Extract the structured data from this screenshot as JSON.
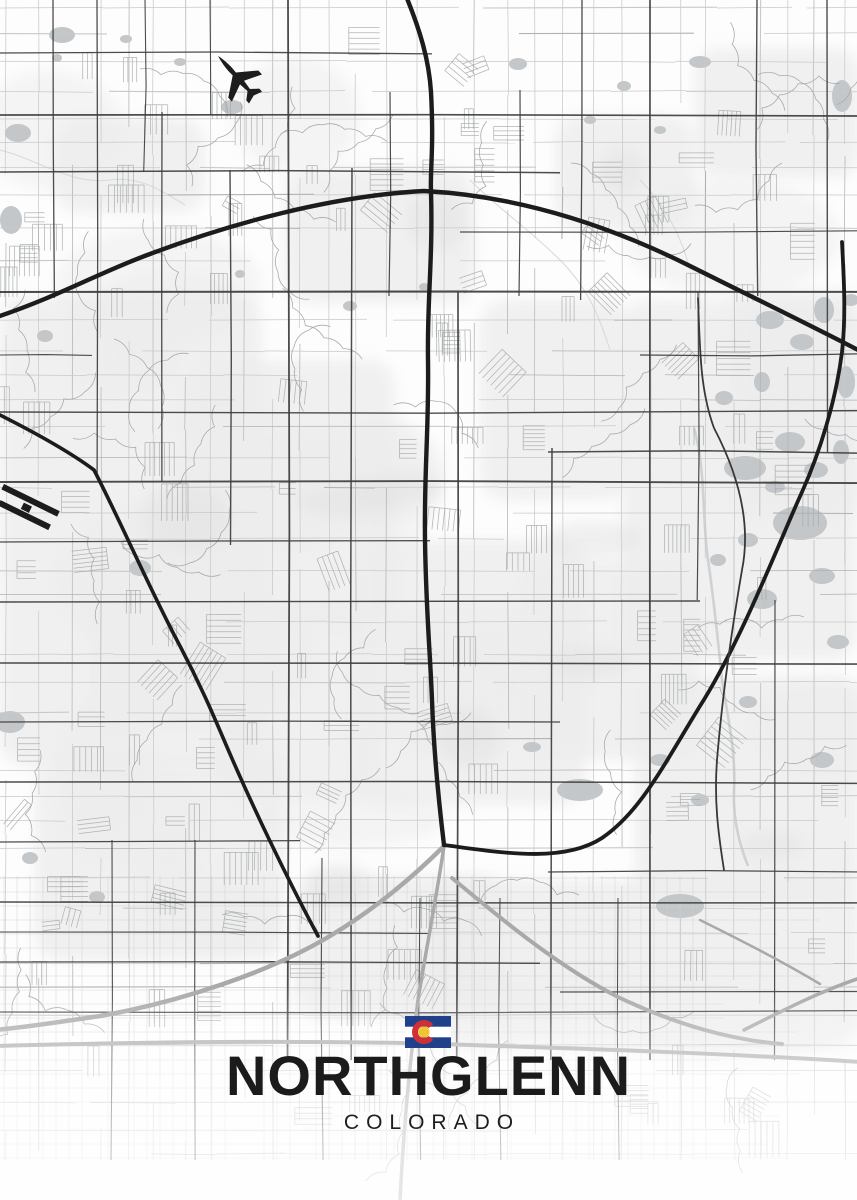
{
  "poster": {
    "title": "NORTHGLENN",
    "subtitle": "COLORADO",
    "flag": {
      "blue": "#20408c",
      "white": "#ffffff",
      "red": "#cf3038",
      "gold": "#f3c432"
    }
  },
  "map": {
    "width": 857,
    "height": 1200,
    "seed": 1337,
    "palette": {
      "bg": "#fdfdfd",
      "patch": "#ededed",
      "patch_dark": "#e2e2e2",
      "water": "#c3c7c9",
      "river": "#ced2d3",
      "stream": "#d8dadb",
      "minor": "#c9c9c9",
      "fine": "#d0d0d0",
      "texture": "#a4a8aa",
      "squiggle": "#a8acae",
      "arterial": "#3d3d3d",
      "highway": "#1c1c1c",
      "highway2": "#383838",
      "gray_highway": "#a9a9a9",
      "fade": "#ffffff"
    },
    "highways": {
      "beltway": {
        "d": "M -6 318 C 60 296 100 272 150 254 C 230 224 330 196 424 191 C 520 196 610 226 690 266 C 750 296 804 322 862 352",
        "w": 4.4
      },
      "i25": {
        "d": "M 406 -4 C 420 30 429 60 431 92 C 434 150 430 170 431 192 C 433 260 427 300 428 360 C 429 430 424 470 425 540 C 426 610 430 650 432 700 C 434 760 440 812 444 845",
        "w": 4.4
      },
      "us85_ne": {
        "d": "M 444 845 C 498 852 562 864 602 838 C 640 812 662 768 700 706 C 742 640 780 540 802 492 C 820 452 836 400 842 352 C 846 316 844 280 842 242",
        "w": 3.8
      },
      "us36_nw": {
        "d": "M -6 412 C 30 430 70 452 94 470 C 120 520 150 590 180 646 C 200 684 212 712 224 740 C 252 806 288 880 318 936",
        "w": 3.6
      },
      "ne_parallel": {
        "d": "M 698 298 C 700 350 700 390 714 428 C 736 470 752 520 742 570 C 730 640 722 700 717 760 C 714 800 718 832 724 870",
        "w": 1.8,
        "alt": true
      }
    },
    "gray_highways": {
      "us36_sw": {
        "d": "M 444 846 C 420 870 380 906 330 936 C 270 972 180 1002 100 1016 C 60 1022 20 1028 -6 1030",
        "w": 4.5
      },
      "i25_s": {
        "d": "M 444 846 C 436 900 426 950 418 1000 C 410 1060 404 1120 400 1200",
        "w": 3.5
      },
      "bottom_av": {
        "d": "M -6 1046 C 150 1042 300 1040 440 1044 C 560 1048 700 1052 862 1062",
        "w": 4.0
      },
      "i76_se": {
        "d": "M 452 878 C 500 918 560 968 620 998 C 680 1026 732 1040 782 1044",
        "w": 4.0
      },
      "ne_branch": {
        "d": "M 744 1030 C 780 1012 818 992 860 978",
        "w": 3.5
      },
      "right_link": {
        "d": "M 700 920 C 740 940 780 960 820 984",
        "w": 2.5
      }
    },
    "arterials": {
      "vertical": [
        [
          53,
          0,
          298,
          1.3
        ],
        [
          97,
          0,
          478,
          1.3
        ],
        [
          145,
          0,
          172,
          1.1
        ],
        [
          162,
          112,
          482,
          1.3
        ],
        [
          210,
          0,
          115,
          1.1
        ],
        [
          230,
          170,
          545,
          1.4
        ],
        [
          288,
          0,
          1060,
          1.8
        ],
        [
          322,
          858,
          1160,
          1.1
        ],
        [
          352,
          168,
          1060,
          1.5
        ],
        [
          390,
          92,
          296,
          1.2
        ],
        [
          458,
          292,
          1060,
          1.7
        ],
        [
          520,
          90,
          296,
          1.2
        ],
        [
          552,
          448,
          1060,
          1.5
        ],
        [
          582,
          0,
          300,
          1.3
        ],
        [
          650,
          0,
          1060,
          1.7
        ],
        [
          698,
          292,
          600,
          1.2
        ],
        [
          757,
          0,
          296,
          1.4
        ],
        [
          775,
          600,
          1060,
          1.2
        ],
        [
          827,
          0,
          452,
          1.4
        ],
        [
          112,
          840,
          1160,
          1.1
        ],
        [
          195,
          840,
          1160,
          1.1
        ],
        [
          420,
          898,
          1160,
          1.0
        ],
        [
          500,
          898,
          1160,
          1.0
        ],
        [
          618,
          898,
          1160,
          1.0
        ]
      ],
      "horizontal": [
        [
          53,
          0,
          432,
          1.3
        ],
        [
          115,
          0,
          862,
          1.7
        ],
        [
          172,
          0,
          560,
          1.5
        ],
        [
          232,
          460,
          862,
          1.2
        ],
        [
          292,
          0,
          862,
          2.0
        ],
        [
          355,
          0,
          92,
          1.1
        ],
        [
          355,
          640,
          862,
          1.3
        ],
        [
          412,
          0,
          862,
          1.4
        ],
        [
          452,
          548,
          862,
          1.5
        ],
        [
          482,
          0,
          862,
          1.9
        ],
        [
          542,
          0,
          430,
          1.3
        ],
        [
          602,
          0,
          700,
          1.4
        ],
        [
          663,
          0,
          862,
          1.6
        ],
        [
          722,
          0,
          560,
          1.3
        ],
        [
          782,
          0,
          862,
          1.5
        ],
        [
          842,
          0,
          300,
          1.3
        ],
        [
          872,
          548,
          862,
          1.2
        ],
        [
          902,
          0,
          862,
          1.5
        ],
        [
          932,
          0,
          430,
          1.1
        ],
        [
          962,
          0,
          540,
          1.3
        ],
        [
          992,
          560,
          862,
          1.2
        ],
        [
          1012,
          0,
          862,
          1.3
        ]
      ]
    },
    "wash_regions": [
      [
        0,
        296,
        262,
        470
      ],
      [
        285,
        168,
        190,
        135
      ],
      [
        622,
        300,
        235,
        360
      ],
      [
        430,
        880,
        430,
        170
      ],
      [
        55,
        118,
        150,
        95
      ],
      [
        185,
        360,
        210,
        265
      ],
      [
        355,
        540,
        230,
        265
      ],
      [
        555,
        115,
        140,
        115
      ],
      [
        635,
        675,
        225,
        225
      ],
      [
        35,
        755,
        250,
        205
      ],
      [
        295,
        875,
        210,
        145
      ],
      [
        695,
        48,
        165,
        130
      ],
      [
        90,
        560,
        180,
        170
      ],
      [
        480,
        300,
        150,
        200
      ],
      [
        210,
        600,
        170,
        200
      ],
      [
        520,
        560,
        180,
        200
      ],
      [
        730,
        290,
        130,
        230
      ]
    ],
    "water": [
      [
        62,
        35,
        13,
        8
      ],
      [
        126,
        39,
        6,
        4
      ],
      [
        57,
        58,
        5,
        4
      ],
      [
        232,
        107,
        11,
        7
      ],
      [
        180,
        62,
        6,
        4
      ],
      [
        18,
        133,
        13,
        9
      ],
      [
        11,
        220,
        11,
        14
      ],
      [
        45,
        336,
        8,
        6
      ],
      [
        350,
        306,
        7,
        5
      ],
      [
        240,
        274,
        5,
        4
      ],
      [
        424,
        287,
        5,
        4
      ],
      [
        140,
        568,
        11,
        8
      ],
      [
        10,
        722,
        15,
        11
      ],
      [
        30,
        858,
        8,
        6
      ],
      [
        97,
        897,
        8,
        6
      ],
      [
        680,
        906,
        24,
        12
      ],
      [
        580,
        790,
        23,
        11
      ],
      [
        532,
        747,
        9,
        5
      ],
      [
        745,
        468,
        21,
        12
      ],
      [
        800,
        523,
        27,
        17
      ],
      [
        762,
        599,
        15,
        10
      ],
      [
        822,
        576,
        13,
        8
      ],
      [
        838,
        642,
        11,
        7
      ],
      [
        842,
        96,
        10,
        16
      ],
      [
        700,
        62,
        11,
        6
      ],
      [
        518,
        64,
        9,
        6
      ],
      [
        822,
        760,
        12,
        8
      ],
      [
        770,
        320,
        14,
        9
      ],
      [
        802,
        342,
        12,
        8
      ],
      [
        824,
        310,
        10,
        13
      ],
      [
        846,
        382,
        9,
        16
      ],
      [
        790,
        442,
        15,
        10
      ],
      [
        816,
        470,
        12,
        8
      ],
      [
        775,
        487,
        10,
        6
      ],
      [
        762,
        382,
        8,
        10
      ],
      [
        841,
        452,
        8,
        12
      ],
      [
        851,
        300,
        8,
        6
      ],
      [
        724,
        398,
        9,
        7
      ],
      [
        748,
        540,
        10,
        7
      ],
      [
        718,
        560,
        8,
        6
      ],
      [
        660,
        760,
        10,
        6
      ],
      [
        700,
        800,
        9,
        6
      ],
      [
        748,
        702,
        9,
        6
      ],
      [
        624,
        86,
        7,
        5
      ],
      [
        590,
        120,
        6,
        4
      ],
      [
        660,
        130,
        6,
        4
      ]
    ],
    "river": "M 694 428 C 706 470 702 520 708 560 C 714 600 718 640 722 680 C 728 720 736 750 734 792 C 733 820 740 846 748 866",
    "streams": [
      "M 0 150 C 40 160 70 185 110 180 C 140 176 160 190 185 205",
      "M 470 180 C 500 210 530 230 560 260 C 590 290 600 320 610 350",
      "M 640 180 C 660 200 680 230 690 270"
    ],
    "airports": {
      "plane": {
        "x": 237,
        "y": 77,
        "rot": -42,
        "scale": 1.35
      },
      "runways": {
        "x": 4,
        "y": 484,
        "rot": 26
      }
    }
  }
}
